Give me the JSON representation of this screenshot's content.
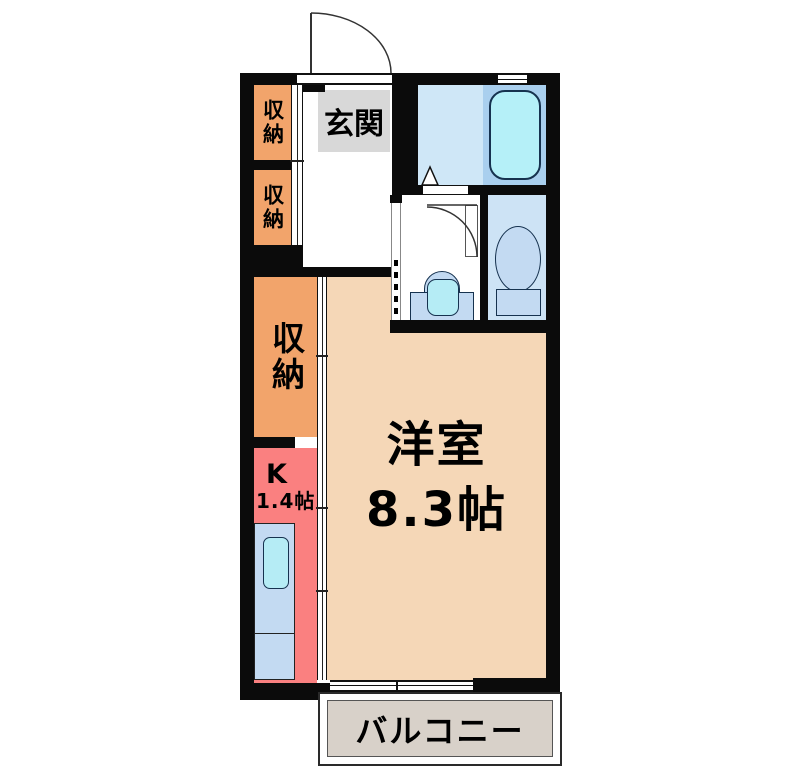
{
  "plan": {
    "type": "japanese-apartment-floor-plan",
    "rooms": {
      "genkan": {
        "label": "玄関"
      },
      "closet_upper_1": {
        "label": "収納"
      },
      "closet_upper_2": {
        "label": "収納"
      },
      "closet_main": {
        "label": "収納"
      },
      "kitchen": {
        "label": "K",
        "size": "1.4帖"
      },
      "western_room": {
        "label": "洋室",
        "size": "8.3帖"
      },
      "balcony": {
        "label": "バルコニー"
      }
    },
    "fixtures": [
      "bathtub",
      "toilet",
      "washbasin",
      "kitchen-sink",
      "entrance-door",
      "bathroom-door",
      "washroom-door",
      "toilet-door",
      "sliding-closet-doors",
      "balcony-window"
    ]
  },
  "palette": {
    "wall": "#0b0b0b",
    "closet": "#f2a46b",
    "kitchen": "#fa8080",
    "room": "#f5d7b7",
    "genkan": "#d8d8d8",
    "balcony": "#d8d1c9",
    "bath_room": "#cfe7f7",
    "tub_deck": "#a9cfee",
    "tub": "#b5f0f8",
    "toilet_room": "#cde3f5",
    "fixture": "#c3daf2",
    "bowl": "#b5ecf5"
  }
}
